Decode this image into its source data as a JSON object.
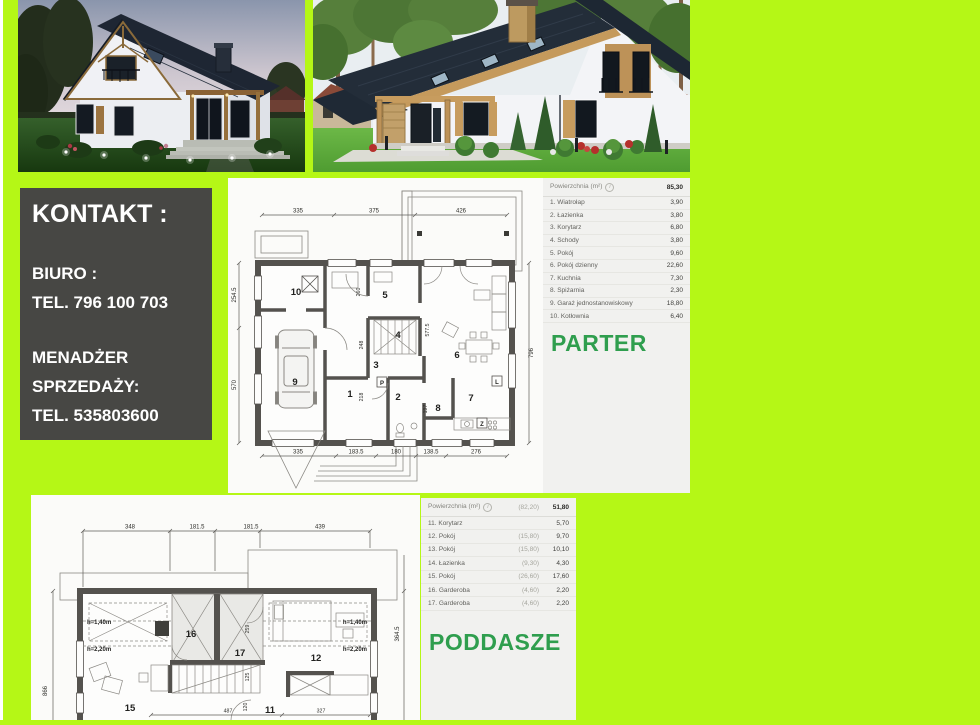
{
  "page": {
    "background_color": "#b5f716",
    "accent_green": "#2f9e4e",
    "contact_box_color": "#474744"
  },
  "photos": {
    "left_alt": "house exterior render at dusk",
    "right_alt": "house exterior render at daytime"
  },
  "contact": {
    "title": "KONTAKT :",
    "office_label": "BIURO :",
    "office_phone": "TEL. 796 100 703",
    "manager_line1": "MENADŻER",
    "manager_line2": "SPRZEDAŻY:",
    "manager_phone": "TEL. 535803600"
  },
  "tables": {
    "info_icon": "i"
  },
  "parter": {
    "title": "PARTER",
    "table": {
      "header_label": "Powierzchnia (m²)",
      "header_total": "85,30",
      "rows": [
        {
          "label": "1. Wiatrołap",
          "value": "3,90"
        },
        {
          "label": "2. Łazienka",
          "value": "3,80"
        },
        {
          "label": "3. Korytarz",
          "value": "6,80"
        },
        {
          "label": "4. Schody",
          "value": "3,80"
        },
        {
          "label": "5. Pokój",
          "value": "9,60"
        },
        {
          "label": "6. Pokój dzienny",
          "value": "22,60"
        },
        {
          "label": "7. Kuchnia",
          "value": "7,30"
        },
        {
          "label": "8. Spiżarnia",
          "value": "2,30"
        },
        {
          "label": "9. Garaż jednostanowiskowy",
          "value": "18,80"
        },
        {
          "label": "10. Kotłownia",
          "value": "6,40"
        }
      ]
    },
    "plan": {
      "dims_top": [
        "335",
        "375",
        "426"
      ],
      "dims_bottom": [
        "335",
        "183.5",
        "180",
        "138.5",
        "276"
      ],
      "dims_left": [
        "254.5",
        "570"
      ],
      "dim_right": "796",
      "dims_inner": [
        "260",
        "248",
        "218",
        "577.5",
        "197"
      ],
      "rooms": [
        "1",
        "2",
        "3",
        "4",
        "5",
        "6",
        "7",
        "8",
        "9",
        "10"
      ],
      "markers": [
        "P",
        "L",
        "Z"
      ]
    }
  },
  "poddasze": {
    "title": "PODDASZE",
    "table": {
      "header_label": "Powierzchnia (m²)",
      "header_paren": "(82,20)",
      "header_total": "51,80",
      "rows": [
        {
          "label": "11. Korytarz",
          "paren": "",
          "value": "5,70"
        },
        {
          "label": "12. Pokój",
          "paren": "(15,80)",
          "value": "9,70"
        },
        {
          "label": "13. Pokój",
          "paren": "(15,80)",
          "value": "10,10"
        },
        {
          "label": "14. Łazienka",
          "paren": "(9,30)",
          "value": "4,30"
        },
        {
          "label": "15. Pokój",
          "paren": "(26,60)",
          "value": "17,60"
        },
        {
          "label": "16. Garderoba",
          "paren": "(4,60)",
          "value": "2,20"
        },
        {
          "label": "17. Garderoba",
          "paren": "(4,60)",
          "value": "2,20"
        }
      ]
    },
    "plan": {
      "dims_top": [
        "348",
        "181.5",
        "181.5",
        "439"
      ],
      "dim_left": "866",
      "dim_right": "364.5",
      "dims_inner": [
        "259",
        "125",
        "120",
        "487",
        "327"
      ],
      "height_left": [
        "h=1,40m",
        "h=2,20m"
      ],
      "height_right": [
        "h=1,40m",
        "h=2,20m"
      ],
      "rooms": [
        "15",
        "16",
        "17",
        "11",
        "12"
      ]
    }
  }
}
